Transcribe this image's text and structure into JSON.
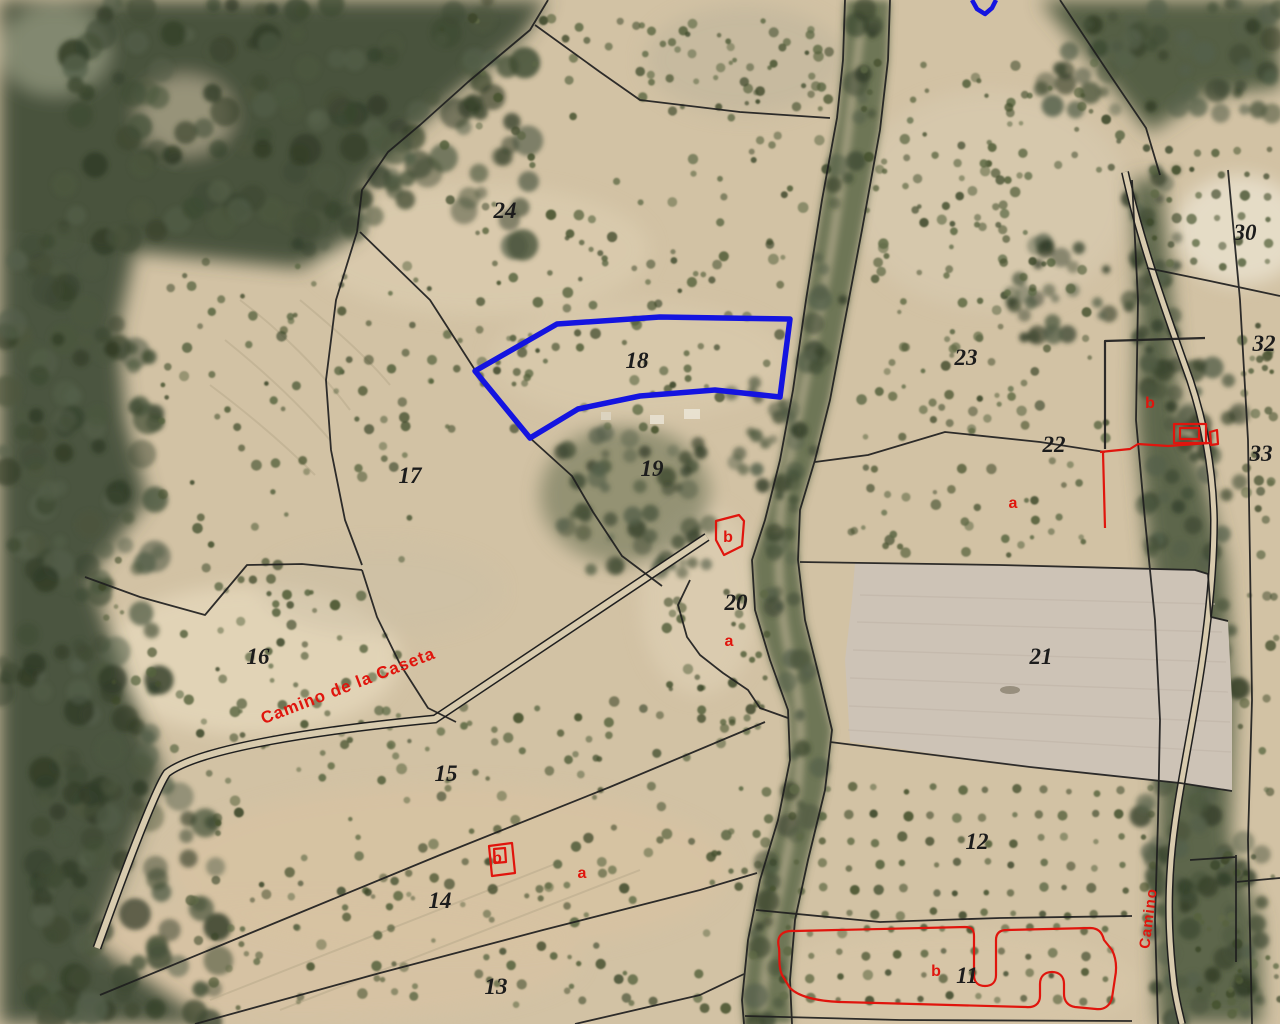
{
  "map": {
    "description": "Aerial cadastral parcel map with selected parcel outline",
    "selected_parcel": "18",
    "parcel_numbers": [
      {
        "label": "24",
        "x": 505,
        "y": 218
      },
      {
        "label": "18",
        "x": 637,
        "y": 368
      },
      {
        "label": "17",
        "x": 410,
        "y": 483
      },
      {
        "label": "19",
        "x": 652,
        "y": 476
      },
      {
        "label": "16",
        "x": 258,
        "y": 664
      },
      {
        "label": "20",
        "x": 736,
        "y": 610
      },
      {
        "label": "23",
        "x": 966,
        "y": 365
      },
      {
        "label": "22",
        "x": 1054,
        "y": 452
      },
      {
        "label": "21",
        "x": 1041,
        "y": 664
      },
      {
        "label": "15",
        "x": 446,
        "y": 781
      },
      {
        "label": "14",
        "x": 440,
        "y": 908
      },
      {
        "label": "13",
        "x": 496,
        "y": 994
      },
      {
        "label": "12",
        "x": 977,
        "y": 849
      },
      {
        "label": "11",
        "x": 967,
        "y": 983
      },
      {
        "label": "30",
        "x": 1245,
        "y": 240
      },
      {
        "label": "32",
        "x": 1264,
        "y": 351
      },
      {
        "label": "33",
        "x": 1261,
        "y": 461
      }
    ],
    "subparcel_letters": [
      {
        "label": "b",
        "x": 728,
        "y": 542
      },
      {
        "label": "a",
        "x": 729,
        "y": 646
      },
      {
        "label": "a",
        "x": 1013,
        "y": 508
      },
      {
        "label": "b",
        "x": 497,
        "y": 863
      },
      {
        "label": "a",
        "x": 582,
        "y": 878
      },
      {
        "label": "b",
        "x": 1150,
        "y": 408
      },
      {
        "label": "b",
        "x": 936,
        "y": 976
      }
    ],
    "road_labels": [
      {
        "label": "Camino de la Caseta",
        "x": 350,
        "y": 691,
        "rotation": -21,
        "size": 17
      },
      {
        "label": "Camino",
        "x": 1153,
        "y": 919,
        "rotation": -83,
        "size": 15
      }
    ],
    "colors": {
      "field_tan": "#d2c2a4",
      "field_light": "#e3d7bd",
      "field_plowed": "#cdc3b6",
      "forest_dark": "#49523c",
      "forest_mid": "#5d664c",
      "stream_green": "#6e7657",
      "boundary_black": "#1f1f1f",
      "selection_blue": "#1414e0",
      "cadastre_red": "#e0150d",
      "label_black": "#1c1c1c",
      "road_fill": "#d8cbae",
      "veg_palette": [
        "#46512f",
        "#55613c",
        "#5f6a46",
        "#3c4729"
      ]
    }
  }
}
